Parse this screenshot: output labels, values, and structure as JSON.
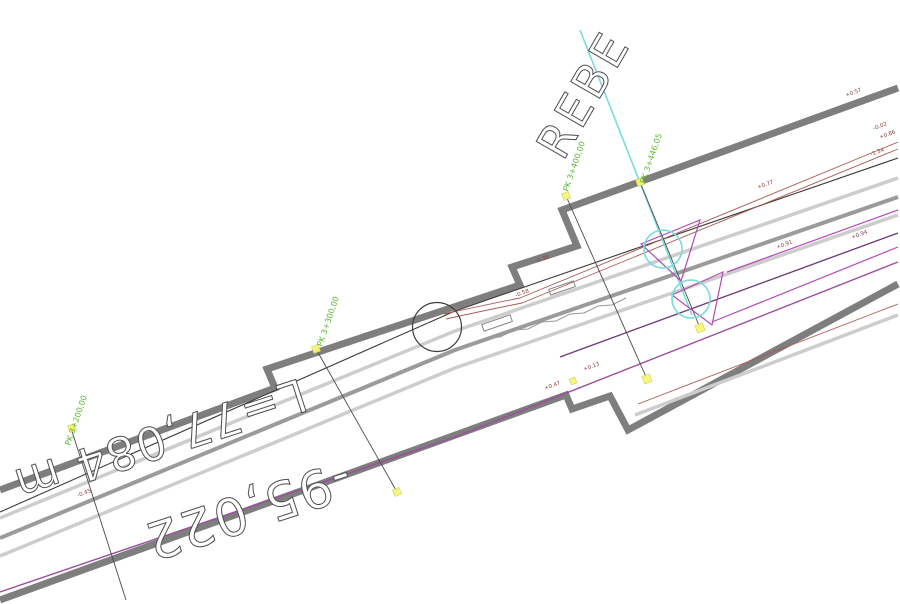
{
  "page": {
    "background": "#ffffff",
    "type": "cad-plan-view"
  },
  "drawing": {
    "big_label": "REBE",
    "dimension_labels": {
      "length": "L=77,084 m",
      "offset": "-95,022"
    },
    "station_labels": [
      "PK 3+200,00",
      "PK 3+300,00",
      "PK 3+400,00",
      "PK 3+446,05"
    ],
    "elevation_labels": [
      "+0.57",
      "-0.02",
      "+0.86",
      "-1.34",
      "+0.77",
      "-0.58",
      "-0.38",
      "+0.13",
      "+0.47",
      "+0.91",
      "+0.94",
      "-0.45"
    ],
    "colors": {
      "wall_gray": "#7e7e7e",
      "line_gray_light": "#cdcdcd",
      "line_gray_mid": "#9b9b9b",
      "alignment_black": "#3a3a3a",
      "edge_red": "#a65a52",
      "magenta": "#9b4f9b",
      "triangle_magenta": "#b44ab4",
      "purple": "#6a3577",
      "cyan": "#76dcdc",
      "station_green": "#5cb832",
      "marker_yellow": "#f5f57a"
    }
  }
}
